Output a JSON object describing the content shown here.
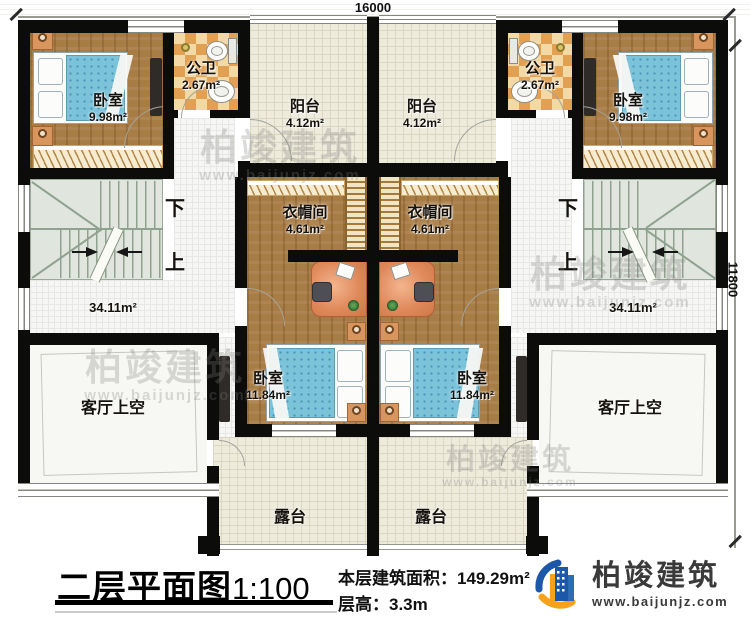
{
  "dimensions": {
    "top": "16000",
    "right": "11800"
  },
  "rooms": {
    "bedroom_tl": {
      "name": "卧室",
      "area": "9.98m²"
    },
    "bedroom_tr": {
      "name": "卧室",
      "area": "9.98m²"
    },
    "bath_l": {
      "name": "公卫",
      "area": "2.67m²"
    },
    "bath_r": {
      "name": "公卫",
      "area": "2.67m²"
    },
    "balcony_l": {
      "name": "阳台",
      "area": "4.12m²"
    },
    "balcony_r": {
      "name": "阳台",
      "area": "4.12m²"
    },
    "cloak_l": {
      "name": "衣帽间",
      "area": "4.61m²"
    },
    "cloak_r": {
      "name": "衣帽间",
      "area": "4.61m²"
    },
    "bedroom_bl": {
      "name": "卧室",
      "area": "11.84m²"
    },
    "bedroom_br": {
      "name": "卧室",
      "area": "11.84m²"
    },
    "hall_l": {
      "area": "34.11m²"
    },
    "hall_r": {
      "area": "34.11m²"
    },
    "void_l": {
      "name": "客厅上空"
    },
    "void_r": {
      "name": "客厅上空"
    },
    "terrace_l": {
      "name": "露台"
    },
    "terrace_r": {
      "name": "露台"
    }
  },
  "stairs": {
    "down": "下",
    "up": "上"
  },
  "titleblock": {
    "title": "二层平面图",
    "scale": "1:100",
    "area_label": "本层建筑面积：",
    "area_value": "149.29m²",
    "height_label": "层高：",
    "height_value": "3.3m"
  },
  "branding": {
    "name": "柏竣建筑",
    "website": "www.baijunjz.com"
  },
  "watermark": {
    "name": "柏竣建筑",
    "website": "www.baijunjz.com"
  }
}
